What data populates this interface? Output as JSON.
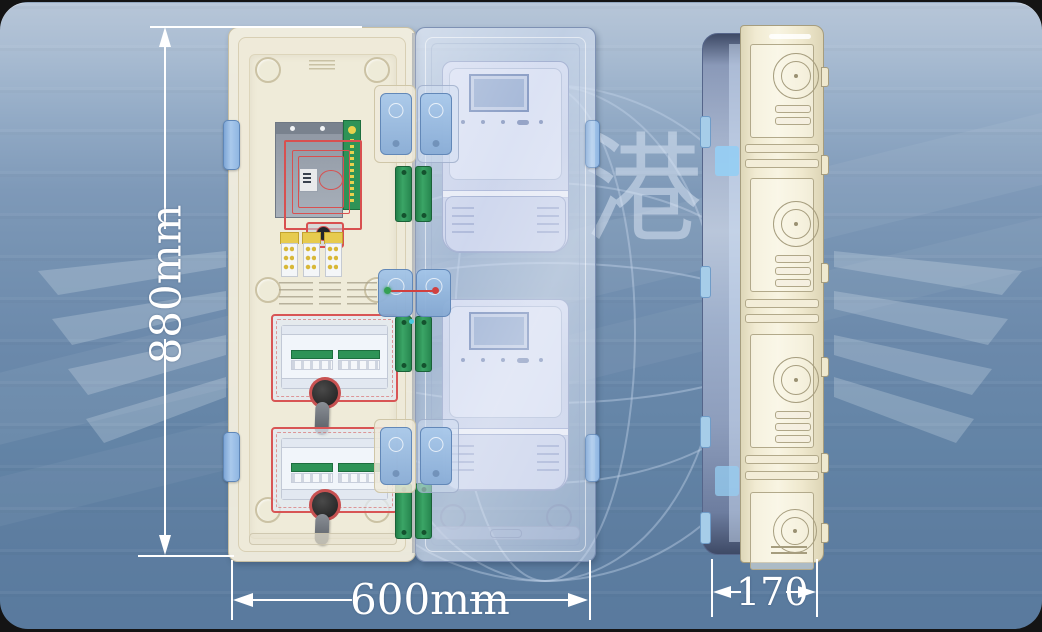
{
  "card": {
    "type": "product-technical-illustration",
    "subject": "two-position transparent electric meter box, front open view and side view"
  },
  "dimensions": {
    "height_label": "880mm",
    "width_label": "600mm",
    "depth_label": "170"
  },
  "watermark": {
    "characters": "恒港"
  },
  "colors": {
    "background_top": "#b7c6d8",
    "background_bottom": "#597a9e",
    "left_door_cream": "#f1edda",
    "right_door_glass": "#c7d6ee",
    "meter_body": "#c9d2ea",
    "meter_lcd": "#9fb3d5",
    "hinge_blue": "#9cc0e8",
    "latch_green": "#2e9357",
    "outline_red": "#d85050",
    "terminal_yellow": "#e7cb4e",
    "mount_plate_gray": "#98a0ac",
    "knob_black": "#2b2b2b",
    "side_body_cream": "#f2ecd4",
    "dimension_white": "#ffffff"
  }
}
